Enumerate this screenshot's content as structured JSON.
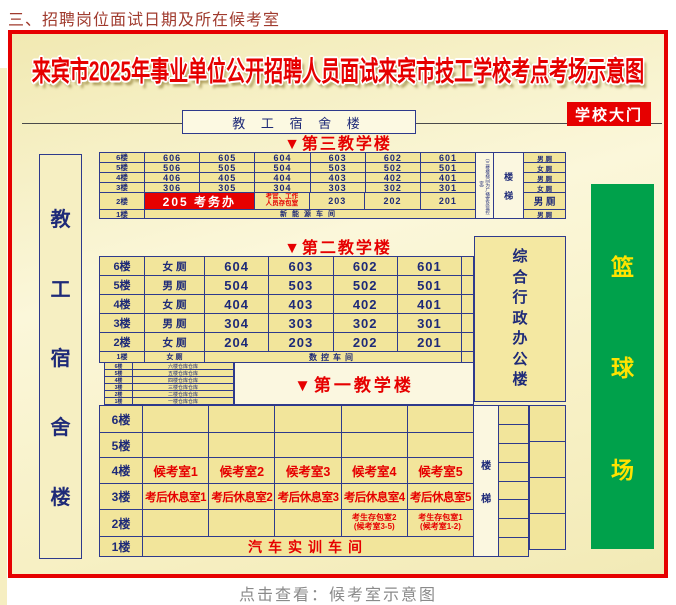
{
  "page": {
    "heading": "三、招聘岗位面试日期及所在候考室",
    "caption": "点击查看：候考室示意图"
  },
  "poster": {
    "title": "来宾市2025年事业单位公开招聘人员面试来宾市技工学校考点考场示意图",
    "gate_label": "学校大门",
    "dorm_top_label": "教 工 宿 舍 楼",
    "dorm_left_chars": [
      "教",
      "工",
      "宿",
      "舍",
      "楼"
    ],
    "admin_chars": [
      "综",
      "合",
      "行",
      "政",
      "办",
      "公",
      "楼"
    ],
    "court_chars": [
      "篮",
      "球",
      "场"
    ],
    "stairs_chars": [
      "楼",
      "梯"
    ],
    "building3": {
      "title": "▼第三教学楼",
      "side_note": "（三楼楼梯间为广播室及监控室）",
      "floors": [
        "6楼",
        "5楼",
        "4楼",
        "3楼",
        "2楼",
        "1楼"
      ],
      "rooms": [
        [
          "606",
          "605",
          "604",
          "603",
          "602",
          "601"
        ],
        [
          "506",
          "505",
          "504",
          "503",
          "502",
          "501"
        ],
        [
          "406",
          "405",
          "404",
          "403",
          "402",
          "401"
        ],
        [
          "306",
          "305",
          "304",
          "303",
          "302",
          "301"
        ]
      ],
      "floor2": {
        "office": "205 考务办",
        "storage_line1": "考官、工作",
        "storage_line2": "人员存包室",
        "rooms": [
          "203",
          "202",
          "201"
        ]
      },
      "floor1_span": "新能源车间",
      "toilets": [
        "男 厕",
        "女 厕",
        "男 厕",
        "女 厕",
        "男 厕",
        "男 厕"
      ]
    },
    "building2": {
      "title": "▼第二教学楼",
      "rows": [
        {
          "floor": "6楼",
          "toilet": "女 厕",
          "rooms": [
            "604",
            "603",
            "602",
            "601"
          ]
        },
        {
          "floor": "5楼",
          "toilet": "男 厕",
          "rooms": [
            "504",
            "503",
            "502",
            "501"
          ]
        },
        {
          "floor": "4楼",
          "toilet": "女 厕",
          "rooms": [
            "404",
            "403",
            "402",
            "401"
          ]
        },
        {
          "floor": "3楼",
          "toilet": "男 厕",
          "rooms": [
            "304",
            "303",
            "302",
            "301"
          ]
        },
        {
          "floor": "2楼",
          "toilet": "女 厕",
          "rooms": [
            "204",
            "203",
            "202",
            "201"
          ]
        }
      ],
      "floor1": {
        "floor": "1楼",
        "toilet": "女 厕",
        "span": "数控车间"
      }
    },
    "annex": {
      "rows": [
        {
          "floor": "6楼",
          "label": "六楼仓库仓库"
        },
        {
          "floor": "5楼",
          "label": "五楼仓库仓库"
        },
        {
          "floor": "4楼",
          "label": "四楼仓库仓库"
        },
        {
          "floor": "3楼",
          "label": "三楼仓库仓库"
        },
        {
          "floor": "2楼",
          "label": "二楼仓库仓库"
        },
        {
          "floor": "1楼",
          "label": "一楼仓库仓库"
        }
      ]
    },
    "building1": {
      "title": "▼第一教学楼",
      "floors": [
        "6楼",
        "5楼",
        "4楼",
        "3楼",
        "2楼",
        "1楼"
      ],
      "floor4_rooms": [
        "候考室1",
        "候考室2",
        "候考室3",
        "候考室4",
        "候考室5"
      ],
      "floor3_rooms": [
        "考后休息室1",
        "考后休息室2",
        "考后休息室3",
        "考后休息室4",
        "考后休息室5"
      ],
      "floor2_storage": [
        {
          "line1": "考生存包室2",
          "line2": "(候考室3-5)"
        },
        {
          "line1": "考生存包室1",
          "line2": "(候考室1-2)"
        }
      ],
      "floor1_span": "汽车实训车间"
    }
  },
  "colors": {
    "accent_red": "#e60000",
    "navy_border": "#2e3a8c",
    "cell_yellow": "#f2e59b",
    "court_green": "#00a14b",
    "court_text": "#ffe300",
    "heading_red": "#a03b2e"
  }
}
